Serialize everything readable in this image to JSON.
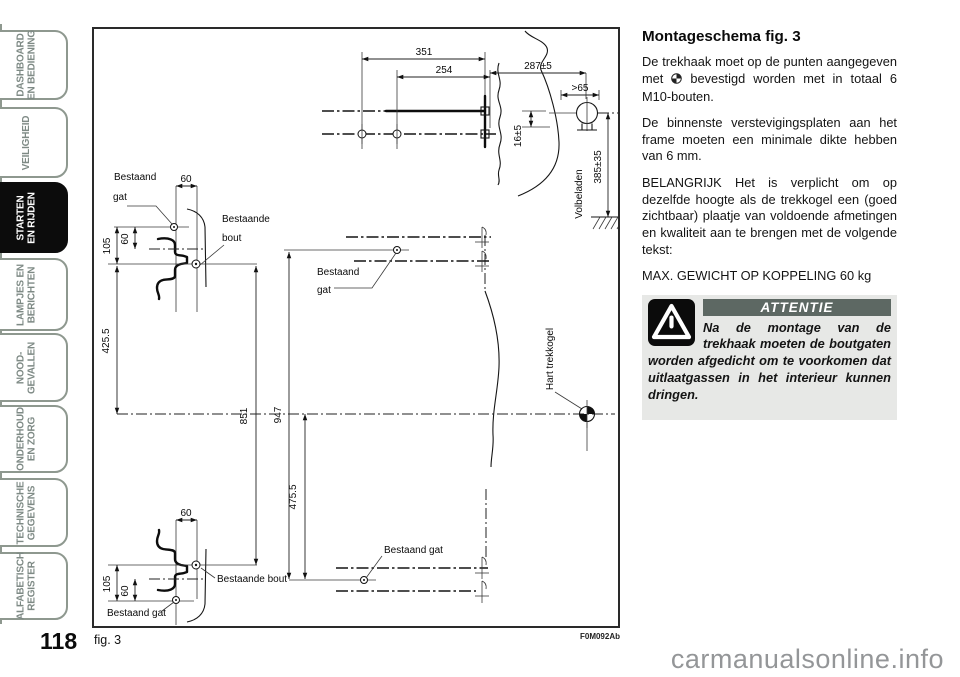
{
  "page": {
    "number": "118",
    "watermark": "carmanualsonline.info"
  },
  "sidebar": {
    "tabs": [
      {
        "lines": [
          "DASHBOARD",
          "EN BEDIENING"
        ],
        "active": false
      },
      {
        "lines": [
          "VEILIGHEID"
        ],
        "active": false
      },
      {
        "lines": [
          "STARTEN",
          "EN RIJDEN"
        ],
        "active": true
      },
      {
        "lines": [
          "LAMPJES EN",
          "BERICHTEN"
        ],
        "active": false
      },
      {
        "lines": [
          "NOOD-",
          "GEVALLEN"
        ],
        "active": false
      },
      {
        "lines": [
          "ONDERHOUD",
          "EN ZORG"
        ],
        "active": false
      },
      {
        "lines": [
          "TECHNISCHE",
          "GEGEVENS"
        ],
        "active": false
      },
      {
        "lines": [
          "ALFABETISCH",
          "REGISTER"
        ],
        "active": false
      }
    ]
  },
  "figure": {
    "caption": "fig. 3",
    "code": "F0M092Ab"
  },
  "diagram": {
    "dim_351": "351",
    "dim_254": "254",
    "dim_287": "287±5",
    "dim_gt65": ">65",
    "dim_16": "16±5",
    "dim_385": "385±35",
    "dim_425": "425.5",
    "dim_851": "851",
    "dim_947": "947",
    "dim_475": "475.5",
    "dim_60": "60",
    "dim_105": "105",
    "label_volbeladen": "Volbeladen",
    "label_bestaand": "Bestaand",
    "label_gat": "gat",
    "label_bestaande": "Bestaande",
    "label_bout": "bout",
    "label_bestaand_gat": "Bestaand gat",
    "label_bestaande_bout": "Bestaande bout",
    "label_hart_trekkogel": "Hart trekkogel"
  },
  "article": {
    "title": "Montageschema fig. 3",
    "para1_before": "De trekhaak moet op de punten aangegeven met",
    "para1_after": "bevestigd worden met in totaal 6 M10-bouten.",
    "para2": "De binnenste verstevigingsplaten aan het frame moeten een minimale dikte hebben van 6 mm.",
    "para3": "BELANGRIJK Het is verplicht om op dezelfde hoogte als de trekkogel een (goed zichtbaar) plaatje van voldoende afmetingen en kwaliteit aan te brengen met de volgende tekst:",
    "para4": "MAX. GEWICHT OP KOPPELING 60 kg",
    "attention": {
      "header": "ATTENTIE",
      "body": "Na de montage van de trekhaak moeten de boutgaten worden afgedicht om te voorkomen dat uitlaatgassen in het interieur kunnen dringen."
    }
  },
  "colors": {
    "tab_gray": "#8e988f",
    "attention_bg": "#e7e8e6",
    "attention_header_bg": "#5d6863",
    "active_tab_bg": "#0c0c0c"
  }
}
